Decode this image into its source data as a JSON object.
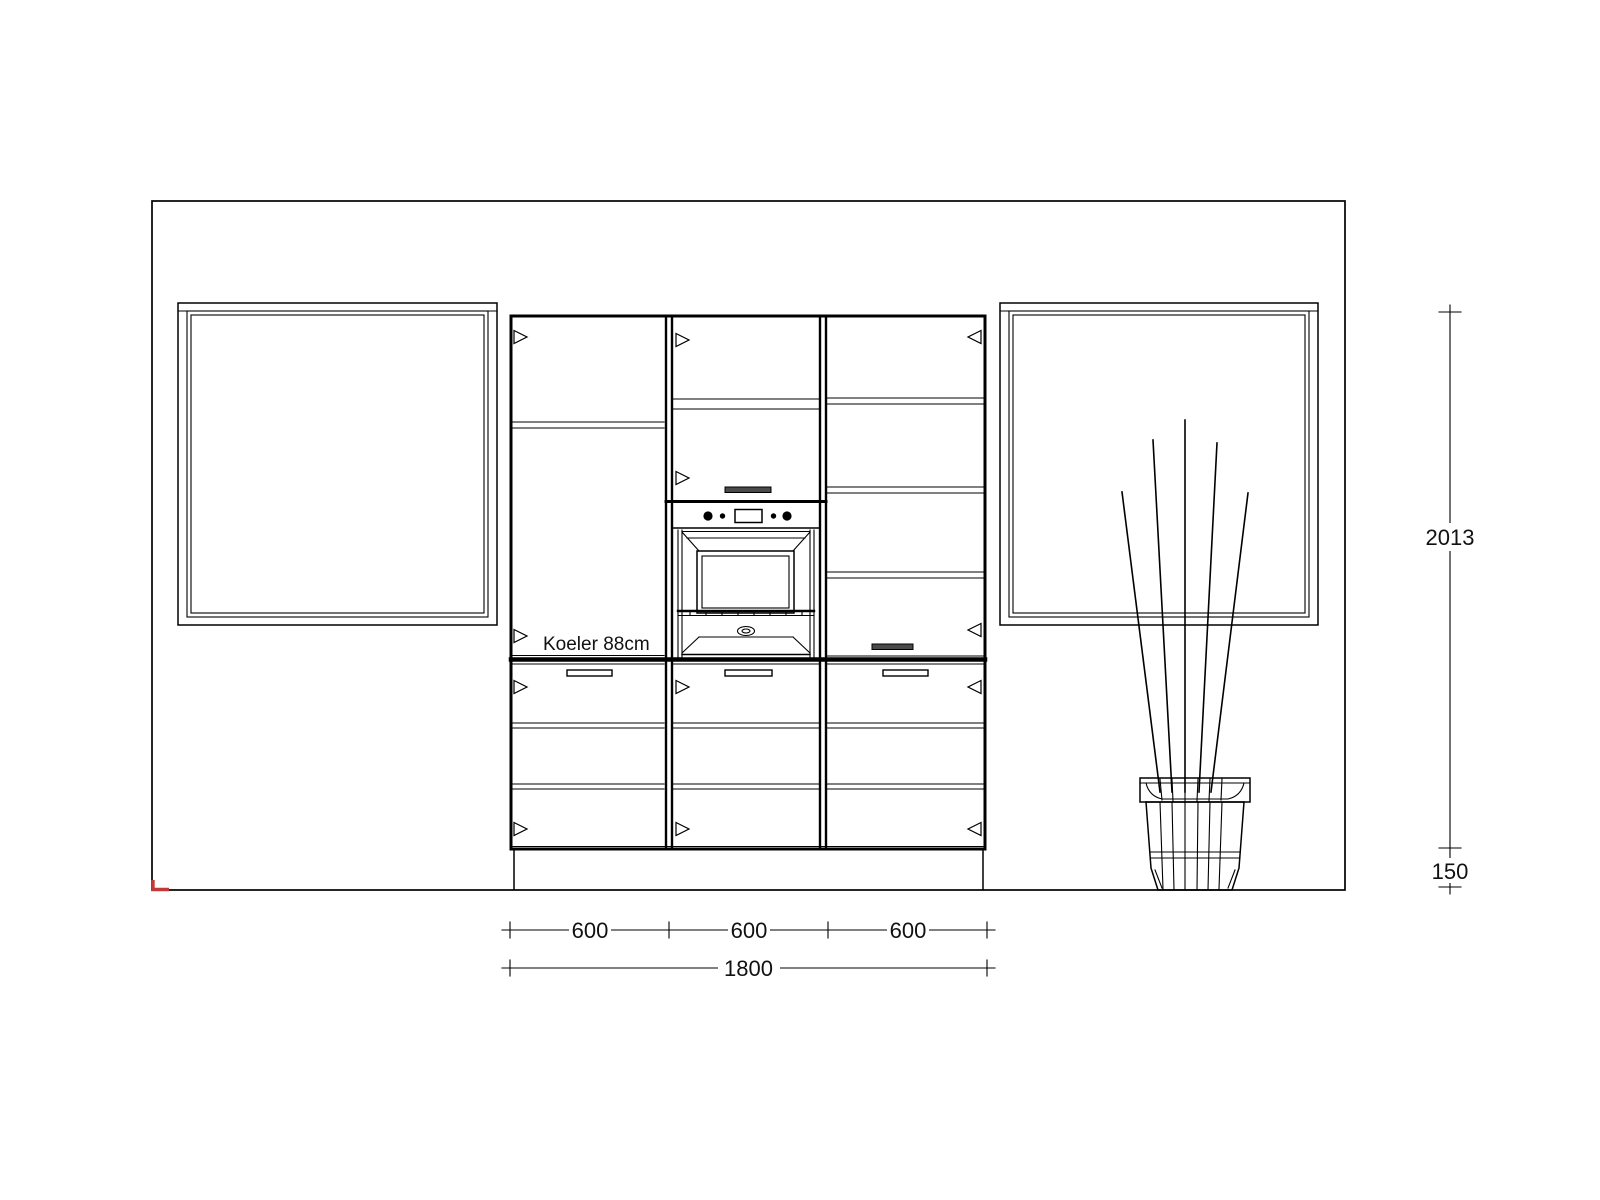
{
  "colors": {
    "background": "#ffffff",
    "line": "#000000",
    "origin_marker_red": "#c13a3a",
    "handle_dark": "#4a4a4a"
  },
  "annotations": {
    "fridge_label": "Koeler 88cm"
  },
  "dimensions": {
    "bottom_segments": [
      {
        "label": "600"
      },
      {
        "label": "600"
      },
      {
        "label": "600"
      }
    ],
    "bottom_total": {
      "label": "1800"
    },
    "right_cabinet_height": {
      "label": "2013"
    },
    "right_plinth_height": {
      "label": "150"
    }
  }
}
